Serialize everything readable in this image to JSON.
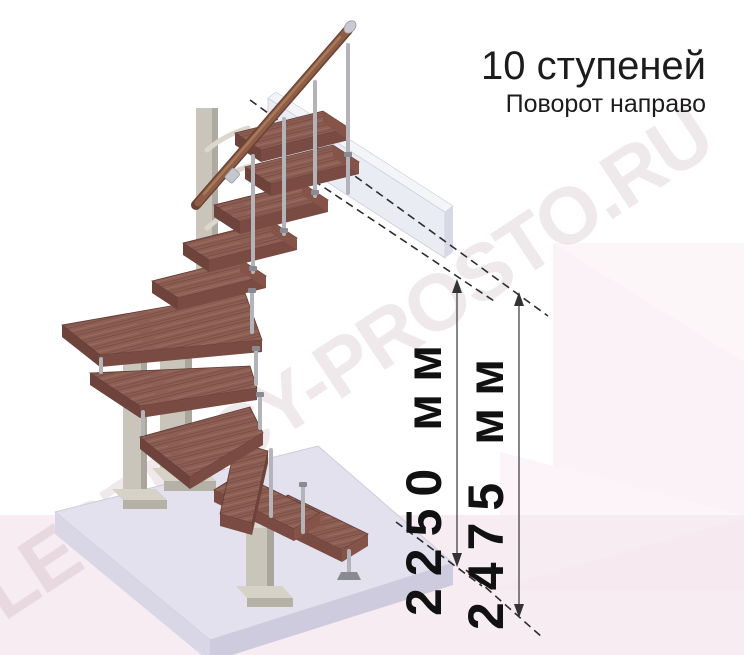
{
  "header": {
    "title": "10 ступеней",
    "subtitle": "Поворот направо"
  },
  "watermark": {
    "text": "LESTNICY-PROSTO.RU"
  },
  "dimensions": [
    {
      "label": "2250 мм",
      "value_mm": 2250
    },
    {
      "label": "2475 мм",
      "value_mm": 2475
    }
  ],
  "figure": {
    "type": "isometric-staircase-drawing",
    "steps_count": 10,
    "turn_direction": "направо",
    "colors": {
      "tread": "#8d5e54",
      "tread_front": "#7a4b42",
      "handrail": "#8f5d45",
      "metal_rod": "#b3b3b9",
      "support_column": "#c9c5ba",
      "floor_slab": "#e3e1ee",
      "upper_beam": "#eaecf4",
      "background_pink": "#f7ecf2",
      "dimension_text": "#111111"
    }
  }
}
